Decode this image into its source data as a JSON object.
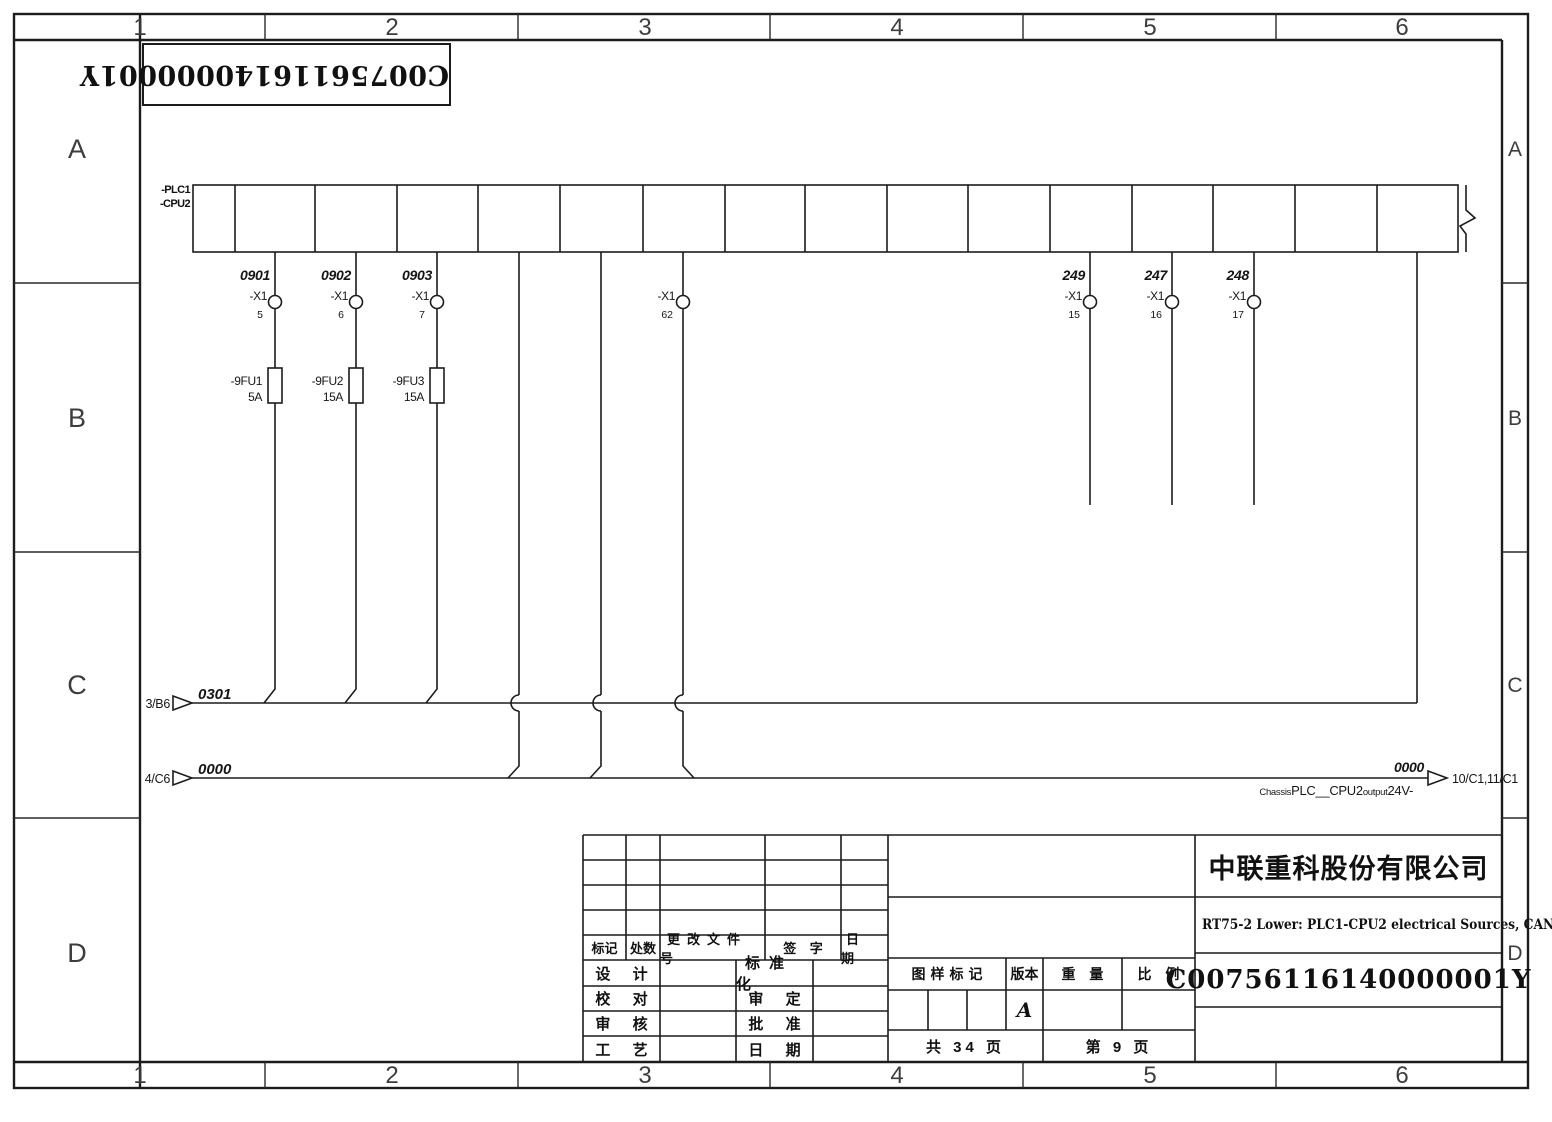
{
  "sheet": {
    "zone_columns": [
      "1",
      "2",
      "3",
      "4",
      "5",
      "6"
    ],
    "zone_rows": [
      "A",
      "B",
      "C",
      "D"
    ]
  },
  "barcode": {
    "text": "C00756116140000001Y"
  },
  "plc": {
    "name_line1": "-PLC1",
    "name_line2": "-CPU2"
  },
  "branches": {
    "b1": {
      "wire_no": "0901",
      "terminal": "-X1",
      "pin": "5",
      "fuse_name": "-9FU1",
      "fuse_rating": "5A"
    },
    "b2": {
      "wire_no": "0902",
      "terminal": "-X1",
      "pin": "6",
      "fuse_name": "-9FU2",
      "fuse_rating": "15A"
    },
    "b3": {
      "wire_no": "0903",
      "terminal": "-X1",
      "pin": "7",
      "fuse_name": "-9FU3",
      "fuse_rating": "15A"
    },
    "b4": {
      "terminal": "-X1",
      "pin": "62"
    },
    "b5": {
      "wire_no": "249",
      "terminal": "-X1",
      "pin": "15"
    },
    "b6": {
      "wire_no": "247",
      "terminal": "-X1",
      "pin": "16"
    },
    "b7": {
      "wire_no": "248",
      "terminal": "-X1",
      "pin": "17"
    }
  },
  "bus_0301": {
    "source_ref": "3/B6",
    "label": "0301"
  },
  "bus_0000": {
    "source_ref": "4/C6",
    "label": "0000",
    "end_label": "0000",
    "dest_ref": "10/C1,11/C1",
    "note_part1": "Chassis",
    "note_part2": "PLC__CPU2",
    "note_part3": "output",
    "note_part4": "24V-"
  },
  "title_block": {
    "rev_headers": {
      "mark": "标记",
      "count": "处数",
      "doc_no": "更改文件号",
      "sign": "签 字",
      "date": "日 期"
    },
    "sign_left": [
      "设 计",
      "校 对",
      "审 核",
      "工 艺"
    ],
    "sign_right": [
      "标准化",
      "审 定",
      "批 准",
      "日 期"
    ],
    "stamp_headers": {
      "mark": "图样标记",
      "version": "版本",
      "weight": "重 量",
      "scale": "比 例"
    },
    "version_value": "A",
    "total_pages": "共 34 页",
    "current_page": "第 9 页",
    "company": "中联重科股份有限公司",
    "drawing_title": "RT75-2 Lower: PLC1-CPU2 electrical Sources, CAN",
    "drawing_no": "C00756116140000001Y"
  }
}
